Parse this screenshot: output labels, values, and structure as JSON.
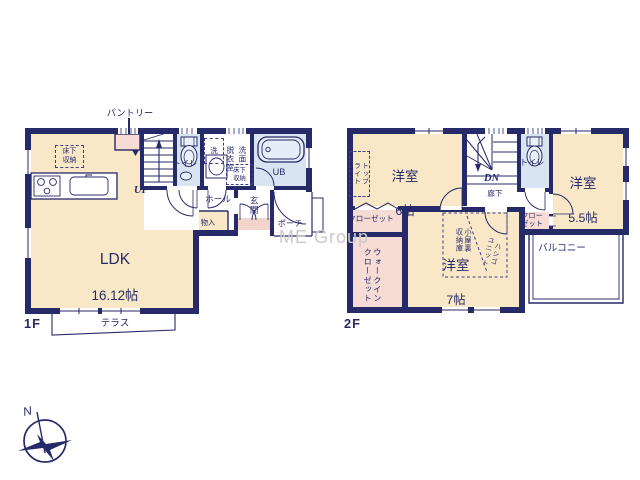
{
  "colors": {
    "wall_navy": "#272a68",
    "room_cream": "#f9e8c7",
    "wet_blue": "#d8e4f1",
    "closet_pink": "#f7dcd6",
    "step_pink": "#f3d4cd",
    "watermark_gray": "#c9c9c9"
  },
  "watermark": "ME Group",
  "compass": {
    "north": "N"
  },
  "floor1": {
    "floor_tag": "1F",
    "pantry": "パントリー",
    "underfloor_storage_kitchen": "床下\n収納",
    "ldk_name": "LDK",
    "ldk_size": "16.12帖",
    "stairs": "UP",
    "toilet": "トイレ",
    "washer": "洗",
    "dressing_room": "脱衣室",
    "washroom": "洗面",
    "underfloor_storage_wash": "床下\n収納",
    "unit_bath": "UB",
    "hall": "ホール",
    "entrance": "玄関",
    "storage": "物入",
    "porch": "ポーチ",
    "terrace": "テラス"
  },
  "floor2": {
    "floor_tag": "2F",
    "room6_name": "洋室",
    "room6_size": "6帖",
    "skylight": "トップ\nライト",
    "stairs": "DN",
    "corridor": "廊下",
    "toilet": "トイレ",
    "room55_name": "洋室",
    "room55_size": "5.5帖",
    "closet_left": "クローゼット",
    "walk_in_closet": "ウォークイン\nクローゼット",
    "room7_name": "洋室",
    "room7_size": "7帖",
    "attic_storage": "小屋裏\n収納庫",
    "ladder_unit": "ハシゴ\nユニット",
    "closet_right": "クロー\nゼット",
    "balcony": "バルコニー"
  }
}
